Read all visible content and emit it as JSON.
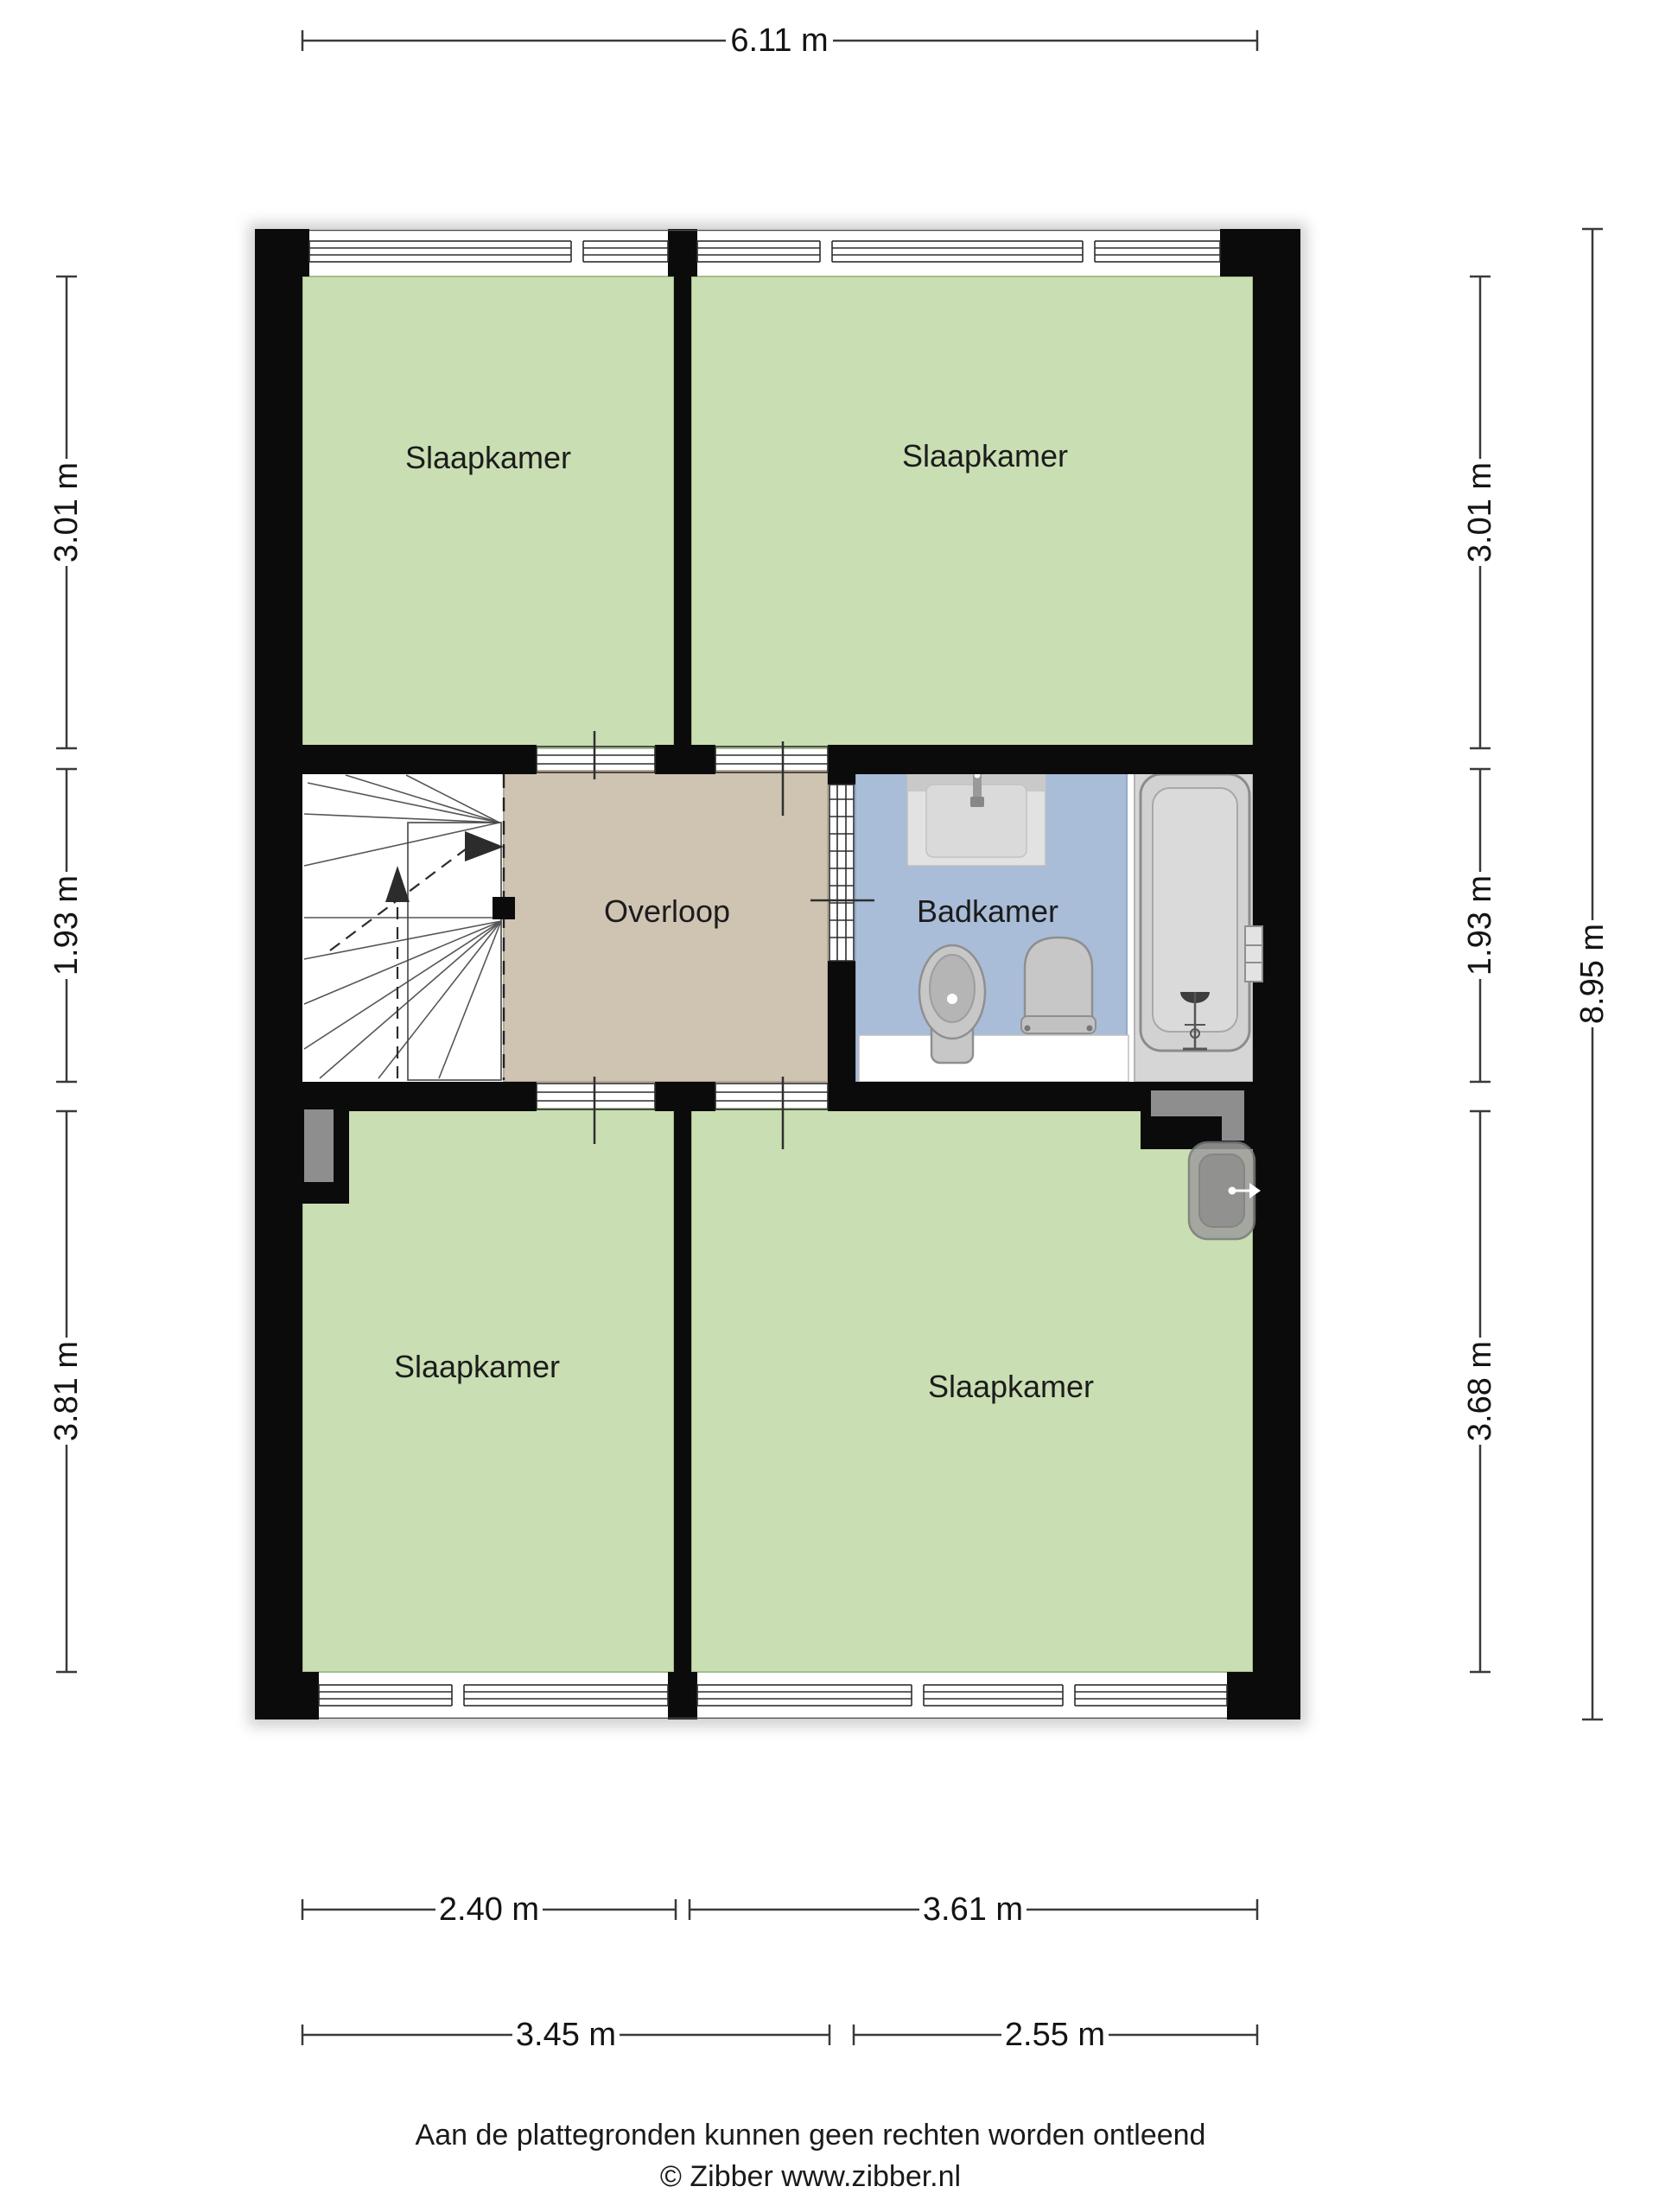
{
  "rooms": {
    "bedroom_top_left": {
      "label": "Slaapkamer"
    },
    "bedroom_top_right": {
      "label": "Slaapkamer"
    },
    "bedroom_bottom_left": {
      "label": "Slaapkamer"
    },
    "bedroom_bottom_right": {
      "label": "Slaapkamer"
    },
    "landing": {
      "label": "Overloop"
    },
    "bathroom": {
      "label": "Badkamer"
    }
  },
  "dimensions": {
    "top_total": "6.11 m",
    "left": [
      "3.01 m",
      "1.93 m",
      "3.81 m"
    ],
    "right": [
      "3.01 m",
      "1.93 m",
      "3.68 m"
    ],
    "right_total": "8.95 m",
    "bottom_room_widths": [
      "2.40 m",
      "3.61 m"
    ],
    "bottom_zone_widths": [
      "3.45 m",
      "2.55 m"
    ]
  },
  "footer": {
    "disclaimer": "Aan de plattegronden kunnen geen rechten worden ontleend",
    "copyright": "© Zibber www.zibber.nl"
  },
  "colors": {
    "wall": "#0b0b0b",
    "bedroom_floor": "#c9deb2",
    "landing_floor": "#cfc3b2",
    "bathroom_floor": "#a9bdd8",
    "bath_zone_floor": "#d6d6d6",
    "fixture_gray": "#c7c7c7",
    "duct_gray": "#8e8e8e",
    "background": "#ffffff"
  }
}
